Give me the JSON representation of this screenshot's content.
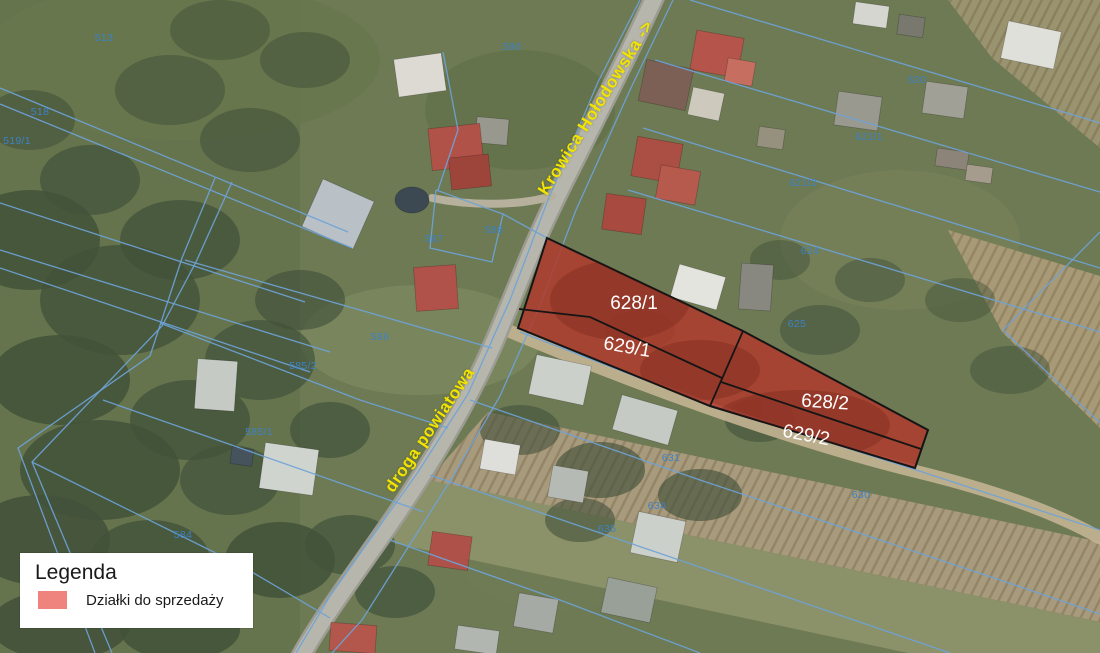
{
  "map": {
    "road_labels": [
      {
        "text": "Krowica Hołodowska ->",
        "x": 596,
        "y": 108,
        "rotation": -58
      },
      {
        "text": "droga powiatowa",
        "x": 430,
        "y": 430,
        "rotation": -56
      }
    ],
    "sale_parcels": [
      {
        "id": "628/1",
        "x": 634,
        "y": 304,
        "rotation": 0
      },
      {
        "id": "629/1",
        "x": 627,
        "y": 348,
        "rotation": 10
      },
      {
        "id": "628/2",
        "x": 825,
        "y": 403,
        "rotation": 4
      },
      {
        "id": "629/2",
        "x": 806,
        "y": 436,
        "rotation": 11
      }
    ],
    "parcel_numbers": [
      {
        "text": "513",
        "x": 104,
        "y": 38
      },
      {
        "text": "518",
        "x": 40,
        "y": 112
      },
      {
        "text": "519/1",
        "x": 17,
        "y": 141
      },
      {
        "text": "590",
        "x": 512,
        "y": 47
      },
      {
        "text": "587",
        "x": 434,
        "y": 239
      },
      {
        "text": "588",
        "x": 494,
        "y": 230
      },
      {
        "text": "586",
        "x": 380,
        "y": 337
      },
      {
        "text": "585/2",
        "x": 303,
        "y": 366
      },
      {
        "text": "585/1",
        "x": 259,
        "y": 432
      },
      {
        "text": "584",
        "x": 183,
        "y": 535
      },
      {
        "text": "620",
        "x": 917,
        "y": 80
      },
      {
        "text": "621/1",
        "x": 869,
        "y": 137
      },
      {
        "text": "621/2",
        "x": 803,
        "y": 183
      },
      {
        "text": "624",
        "x": 810,
        "y": 251
      },
      {
        "text": "625",
        "x": 797,
        "y": 324
      },
      {
        "text": "631",
        "x": 671,
        "y": 458
      },
      {
        "text": "634",
        "x": 657,
        "y": 506
      },
      {
        "text": "635",
        "x": 607,
        "y": 529
      },
      {
        "text": "630",
        "x": 861,
        "y": 495
      }
    ]
  },
  "legend": {
    "title": "Legenda",
    "items": [
      {
        "label": "Działki do sprzedaży"
      }
    ]
  },
  "colors": {
    "cadastral_line": "#6ea3d8",
    "num_color": "#3c82c6",
    "road_label_color": "#f2e400",
    "sale_fill": "#b0392c",
    "sale_stroke": "#151515",
    "sale_label_color": "#ffffff",
    "legend_swatch": "#ef837d"
  }
}
